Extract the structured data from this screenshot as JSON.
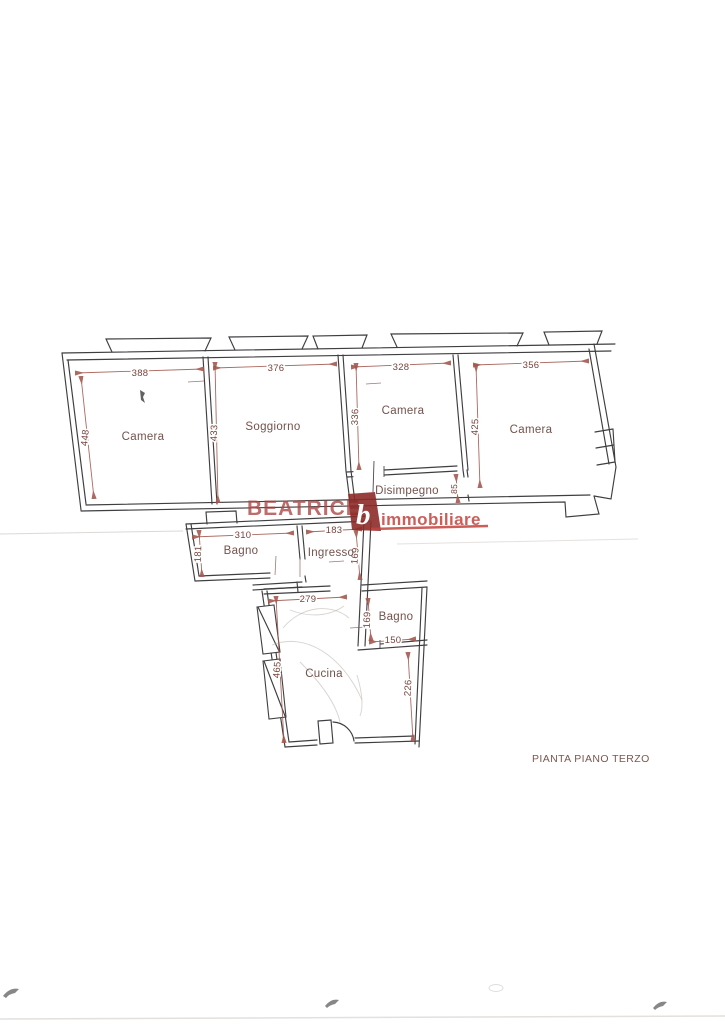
{
  "title": "PIANTA PIANO TERZO",
  "watermark": {
    "brand": "BEATRICE",
    "logo_letter": "b",
    "word": "immobiliare"
  },
  "rooms": {
    "camera_nw": {
      "label": "Camera"
    },
    "soggiorno": {
      "label": "Soggiorno"
    },
    "camera_mid": {
      "label": "Camera"
    },
    "camera_ne": {
      "label": "Camera"
    },
    "disimpegno": {
      "label": "Disimpegno"
    },
    "bagno_mid": {
      "label": "Bagno"
    },
    "ingresso": {
      "label": "Ingresso"
    },
    "cucina": {
      "label": "Cucina"
    },
    "bagno_small": {
      "label": "Bagno"
    }
  },
  "dims": {
    "camera_nw_w": "388",
    "camera_nw_h": "448",
    "soggiorno_w": "376",
    "soggiorno_h": "433",
    "camera_mid_w": "328",
    "camera_mid_h": "336",
    "camera_ne_w": "356",
    "camera_ne_h": "425",
    "disimpegno_h": "85",
    "bagno_mid_w": "310",
    "bagno_mid_h": "181",
    "ingresso_w": "183",
    "ingresso_h": "169",
    "cucina_w": "279",
    "cucina_h": "465",
    "cucina_h2": "226",
    "bagno_small_h": "169",
    "bagno_small_w": "150"
  },
  "colors": {
    "walls": "#3f3e41",
    "dimension_lines": "#a2594f",
    "dimension_text": "#77443c",
    "room_labels": "#74524b",
    "watermark_brand": "#aa4543",
    "watermark_word": "#c4423e",
    "watermark_logo_bg": "#8d2b29",
    "title_text": "#7d564e"
  }
}
